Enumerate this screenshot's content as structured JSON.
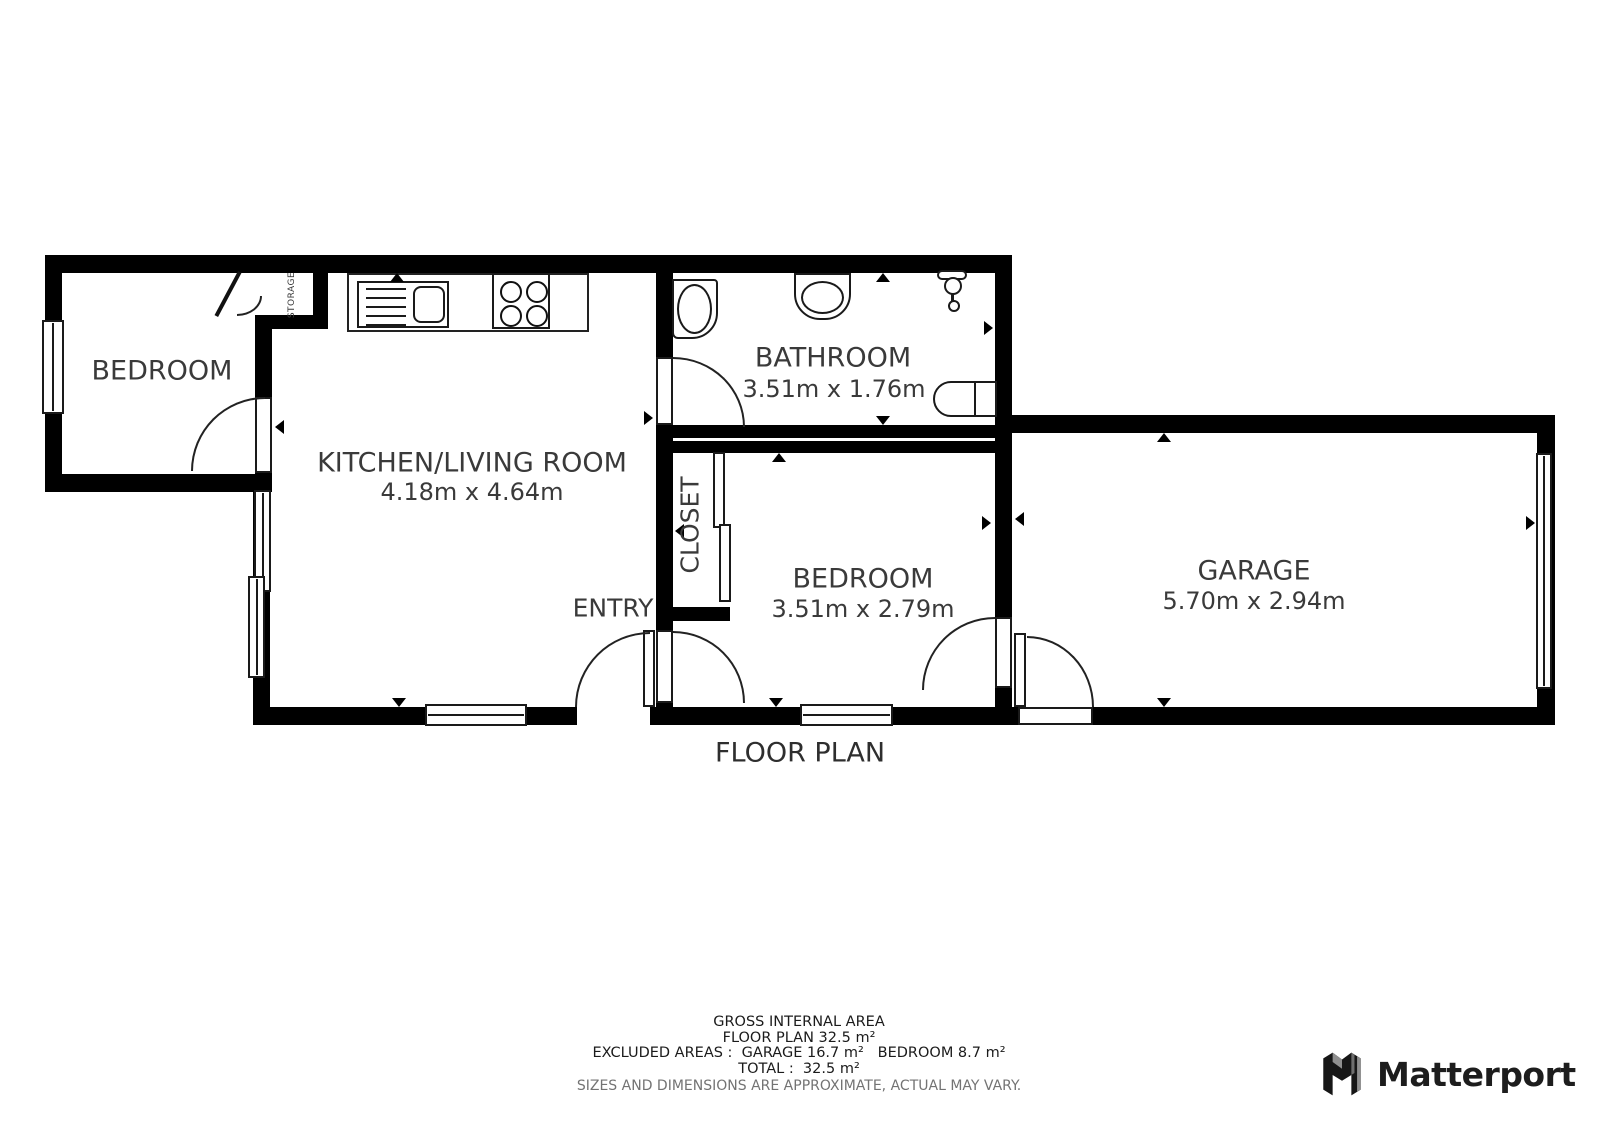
{
  "title": "FLOOR PLAN",
  "rooms": {
    "bedroom_left": {
      "label": "BEDROOM"
    },
    "kitchen_living": {
      "label": "KITCHEN/LIVING ROOM",
      "dims": "4.18m x 4.64m"
    },
    "bathroom": {
      "label": "BATHROOM",
      "dims": "3.51m x 1.76m"
    },
    "closet": {
      "label": "CLOSET"
    },
    "storage": {
      "label": "STORAGE"
    },
    "bedroom_middle": {
      "label": "BEDROOM",
      "dims": "3.51m x 2.79m"
    },
    "garage": {
      "label": "GARAGE",
      "dims": "5.70m x 2.94m"
    },
    "entry": {
      "label": "ENTRY"
    }
  },
  "footer": {
    "line1": "GROSS INTERNAL AREA",
    "line2": "FLOOR PLAN 32.5 m²",
    "line3": "EXCLUDED AREAS :  GARAGE 16.7 m²   BEDROOM 8.7 m²",
    "line4": "TOTAL :  32.5 m²",
    "disclaimer": "SIZES AND DIMENSIONS ARE APPROXIMATE, ACTUAL MAY VARY."
  },
  "branding": {
    "name": "Matterport"
  },
  "colors": {
    "wall": "#000000",
    "label_text": "#3a3a3a",
    "muted_text": "#737373",
    "line": "#1a1a1a"
  }
}
